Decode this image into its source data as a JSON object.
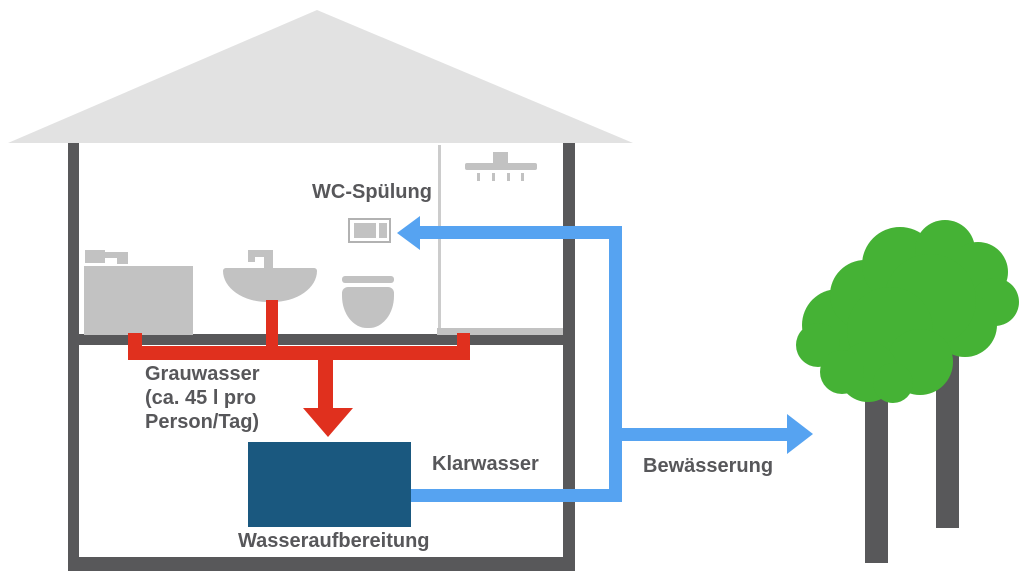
{
  "diagram": {
    "type": "greywater-recycling-house-schematic",
    "labels": {
      "wc_flush": "WC-Spülung",
      "greywater": "Grauwasser\n(ca. 45 l pro\nPerson/Tag)",
      "clearwater": "Klarwasser",
      "water_treatment": "Wasseraufbereitung",
      "irrigation": "Bewässerung"
    },
    "colors": {
      "roof": "#e2e2e2",
      "wall": "#58585a",
      "fixture": "#c2c2c2",
      "partition": "#cccccc",
      "greywater_pipe": "#e0301e",
      "clearwater_pipe": "#56a3f1",
      "tank": "#1a587f",
      "tree_foliage": "#45b235",
      "tree_trunk": "#58585a",
      "label_text": "#57575a"
    },
    "icons": [
      "roof-icon",
      "bathtub-icon",
      "faucet-icon",
      "washbasin-icon",
      "toilet-icon",
      "shower-head-icon",
      "wc-flush-plate-icon",
      "water-tank-icon",
      "arrow-icon",
      "tree-icon"
    ]
  }
}
